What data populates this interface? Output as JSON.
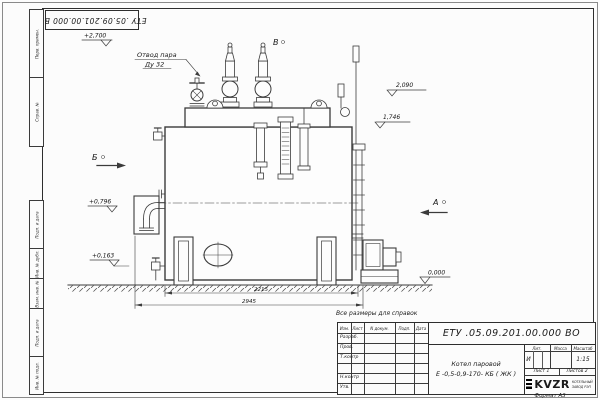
{
  "sheet": {
    "doc_number": "ЕТУ .05.09.201.00.000  ВО",
    "format_note": "Формат А3",
    "reference_note": "Все размеры для справок"
  },
  "margin_labels": {
    "perv": "Перв. примен.",
    "sprav": "Справ. №",
    "podp1": "Подп. и дата",
    "inv_dubl": "Инв. № дубл.",
    "vzam": "Взам. инв. №",
    "podp2": "Подп. и дата",
    "inv_podl": "Инв. № подл."
  },
  "title_block": {
    "doc_number": "ЕТУ .05.09.201.00.000  ВО",
    "name_line1": "Котел паровой",
    "name_line2": "Е -0,5-0,9-170- КБ ( ЖК )",
    "cols": {
      "izm": "Изм.",
      "list": "Лист",
      "doc": "N докум.",
      "podp": "Подп.",
      "data": "Дата"
    },
    "rows": {
      "r1": "Разраб.",
      "r2": "Пров.",
      "r3": "Т.контр",
      "r4": "",
      "r5": "Н.контр",
      "r6": "Утв."
    },
    "lit_label": "Лит.",
    "lit_value": "И",
    "mass_label": "Масса",
    "scale_label": "Масштаб",
    "scale_value": "1:15",
    "sheet_label": "Лист",
    "sheet_value": "1",
    "sheets_label": "Листов",
    "sheets_value": "2",
    "logo": "KVZR",
    "company_line1": "КОТЕЛЬНЫЙ",
    "company_line2": "ЗАВОД РЭП"
  },
  "drawing": {
    "callout_line1": "Отвод пара",
    "callout_line2": "Ду 32",
    "views": {
      "a": "А",
      "b": "Б",
      "v": "В"
    },
    "elevations": {
      "e2700": "+2,700",
      "e2090": "2,090",
      "e1746": "1,746",
      "e0796": "+0,796",
      "e0163": "+0,163",
      "e0000": "0,000"
    },
    "dims": {
      "d1": "2215",
      "d2": "2945"
    }
  }
}
